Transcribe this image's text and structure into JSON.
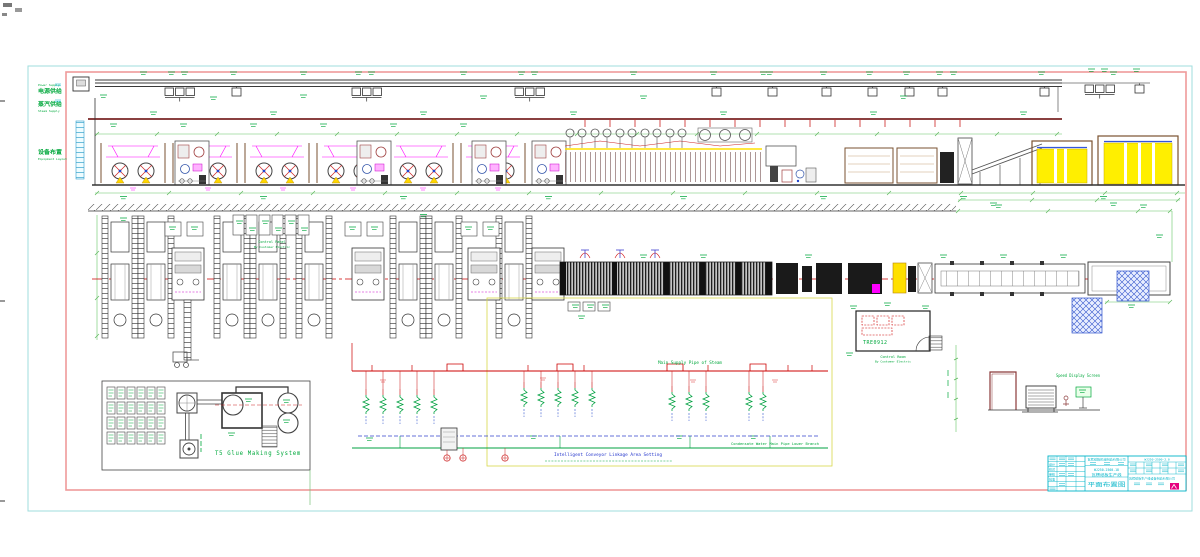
{
  "drawing": {
    "margin": {
      "power_cn": "电源供给",
      "power_en": "Power Supply",
      "steam_cn": "蒸汽供给",
      "steam_en": "Steam Supply",
      "layout_cn": "设备布置",
      "layout_en": "Equipment Layout"
    },
    "plan": {
      "panel_caption1": "Control Panel",
      "panel_caption2": "By Customer Electric"
    },
    "control_room": {
      "code": "TRE0912",
      "caption": "Control Room",
      "note": "By Customer Electric"
    },
    "glue": {
      "title": "T5 Glue Making System"
    },
    "steam": {
      "main_label": "Main Supply Pipe of Steam",
      "condensate_label": "Condensate Water Main Pipe Lower Branch",
      "note": "Intelligent Conveyor Linkage Area Setting"
    },
    "speed": {
      "label": "Speed Display Screen"
    }
  },
  "title_block": {
    "design": "设计",
    "check": "校对",
    "audit": "审核",
    "approve": "批准",
    "company": "瓦楞纸箱机械制造有限公司",
    "model": "WJ250-2500-18",
    "product": "瓦楞纸板生产线",
    "sheet_title": "平面布置图",
    "drawing_no": "WJ250-2500-2.0",
    "footer": "瓦楞纸板生产线设备制造有限公司"
  },
  "colors": {
    "cad_green": "#00a83c",
    "cad_magenta": "#ff00ff",
    "cad_cyan": "#00b4c8",
    "frame_pink": "#ef9a9a",
    "frame_cyan": "#9fdede",
    "stack_yellow": "#ffef00",
    "pipe_maroon": "#7a2424"
  }
}
